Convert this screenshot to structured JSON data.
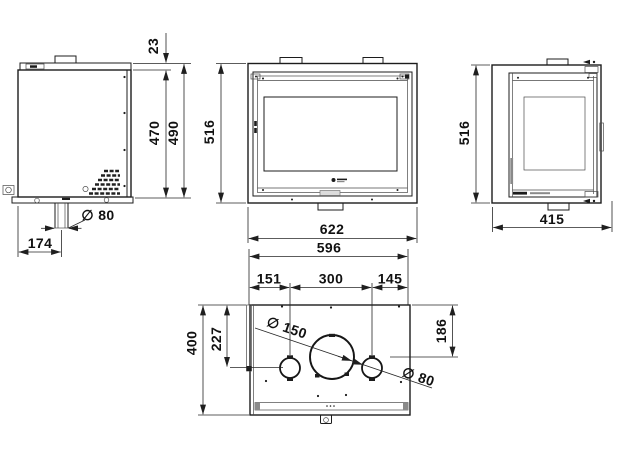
{
  "views": {
    "side_left": {
      "dims": {
        "collar_height": "23",
        "body_height": "470",
        "overall_height": "490",
        "air_inlet_diameter": "∅ 80",
        "air_inlet_offset": "174"
      }
    },
    "front": {
      "dims": {
        "frame_height": "516",
        "overall_width": "622",
        "body_width": "596"
      }
    },
    "side_right": {
      "dims": {
        "frame_height": "516",
        "overall_depth": "415"
      }
    },
    "top": {
      "dims": {
        "left_segment": "151",
        "center_segment": "300",
        "right_segment": "145",
        "air_inlet_axis_depth": "227",
        "flue_axis_depth": "186",
        "overall_depth": "400",
        "flue_diameter": "∅ 150",
        "air_inlet_diameter": "∅ 80"
      }
    }
  }
}
